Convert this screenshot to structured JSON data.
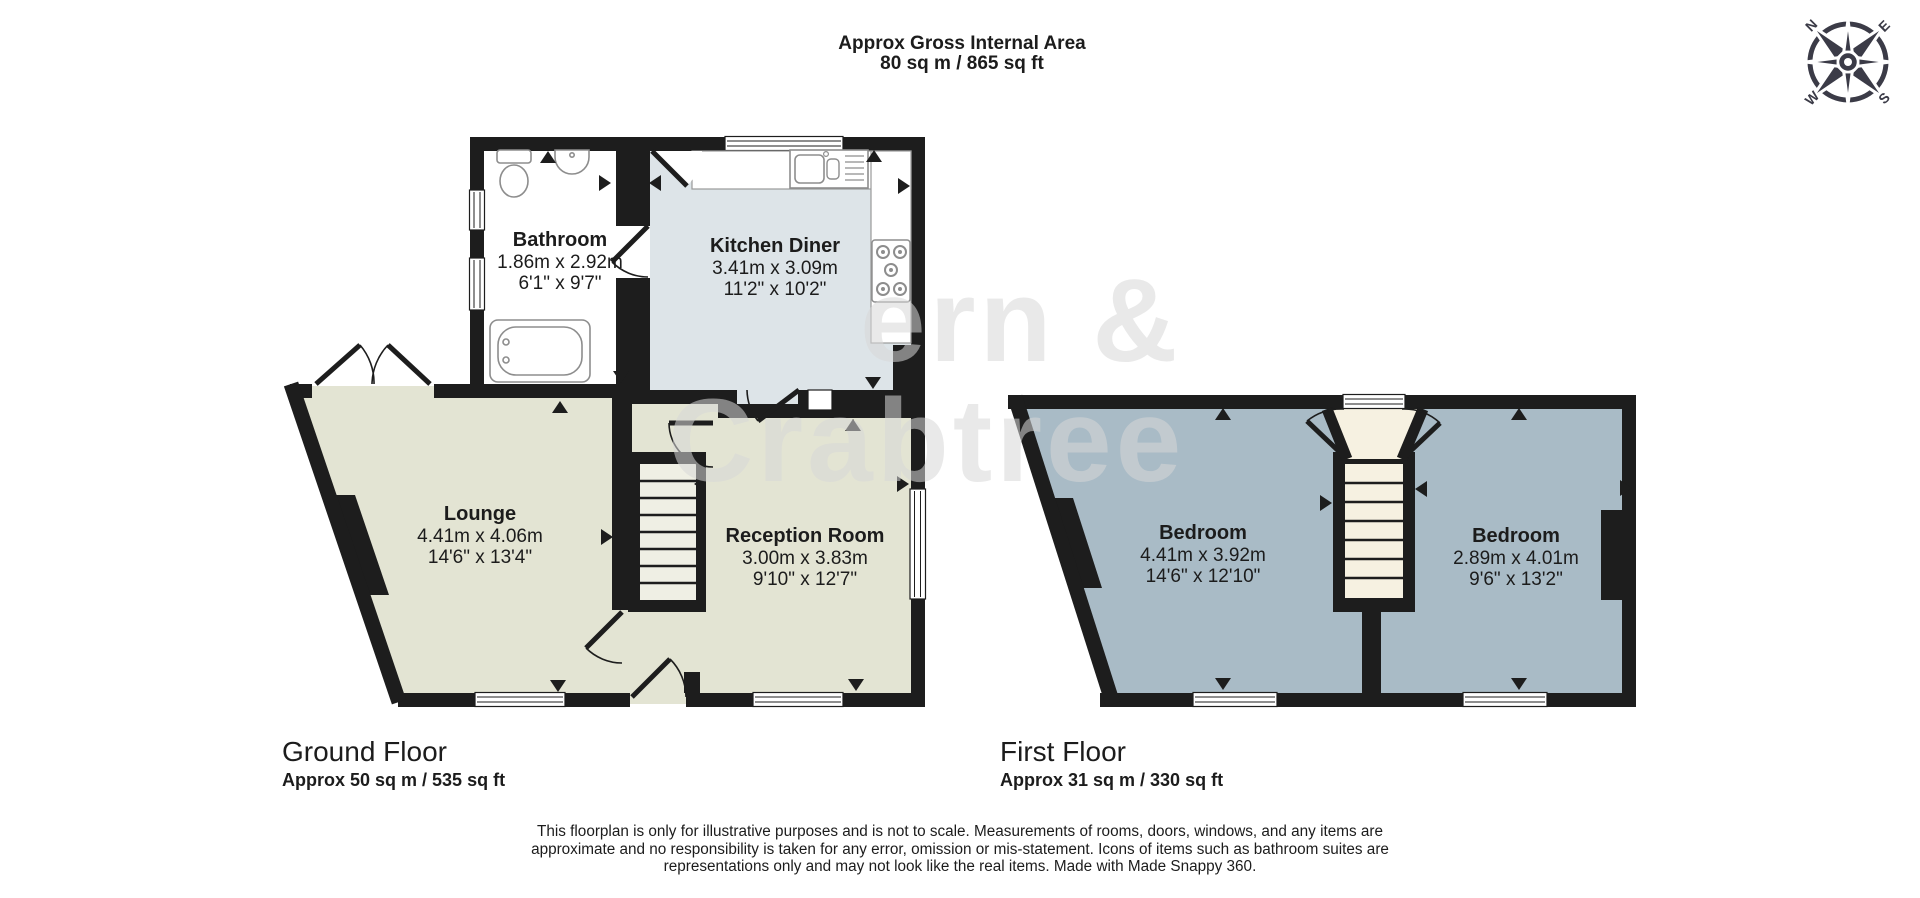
{
  "header": {
    "line1": "Approx Gross Internal Area",
    "line2": "80 sq m / 865 sq ft"
  },
  "compass": {
    "n": "N",
    "e": "E",
    "s": "S",
    "w": "W"
  },
  "watermark": {
    "line1": "ern &",
    "line2": "Crabtree"
  },
  "floors": {
    "ground": {
      "label": "Ground Floor",
      "area": "Approx 50 sq m / 535 sq ft",
      "rooms": [
        {
          "name": "Bathroom",
          "metric": "1.86m x 2.92m",
          "imperial": "6'1\" x 9'7\""
        },
        {
          "name": "Kitchen Diner",
          "metric": "3.41m x 3.09m",
          "imperial": "11'2\" x 10'2\""
        },
        {
          "name": "Lounge",
          "metric": "4.41m x 4.06m",
          "imperial": "14'6\" x 13'4\""
        },
        {
          "name": "Reception Room",
          "metric": "3.00m x 3.83m",
          "imperial": "9'10\" x 12'7\""
        }
      ]
    },
    "first": {
      "label": "First Floor",
      "area": "Approx 31 sq m / 330 sq ft",
      "rooms": [
        {
          "name": "Bedroom",
          "metric": "4.41m x 3.92m",
          "imperial": "14'6\" x 12'10\""
        },
        {
          "name": "Bedroom",
          "metric": "2.89m x 4.01m",
          "imperial": "9'6\" x 13'2\""
        }
      ]
    }
  },
  "disclaimer": "This floorplan is only for illustrative purposes and is not to scale. Measurements of rooms, doors, windows, and any items are approximate and no responsibility is taken for any error, omission or mis-statement. Icons of items such as bathroom suites are representations only and may not look like the real items. Made with Made Snappy 360.",
  "colors": {
    "wall": "#1d1d1d",
    "lounge_reception": "#e3e4d3",
    "kitchen": "#dde4e8",
    "bedroom": "#a9bbc6",
    "stairs_landing": "#f6f1e1",
    "watermark": "#d8d8d8"
  }
}
